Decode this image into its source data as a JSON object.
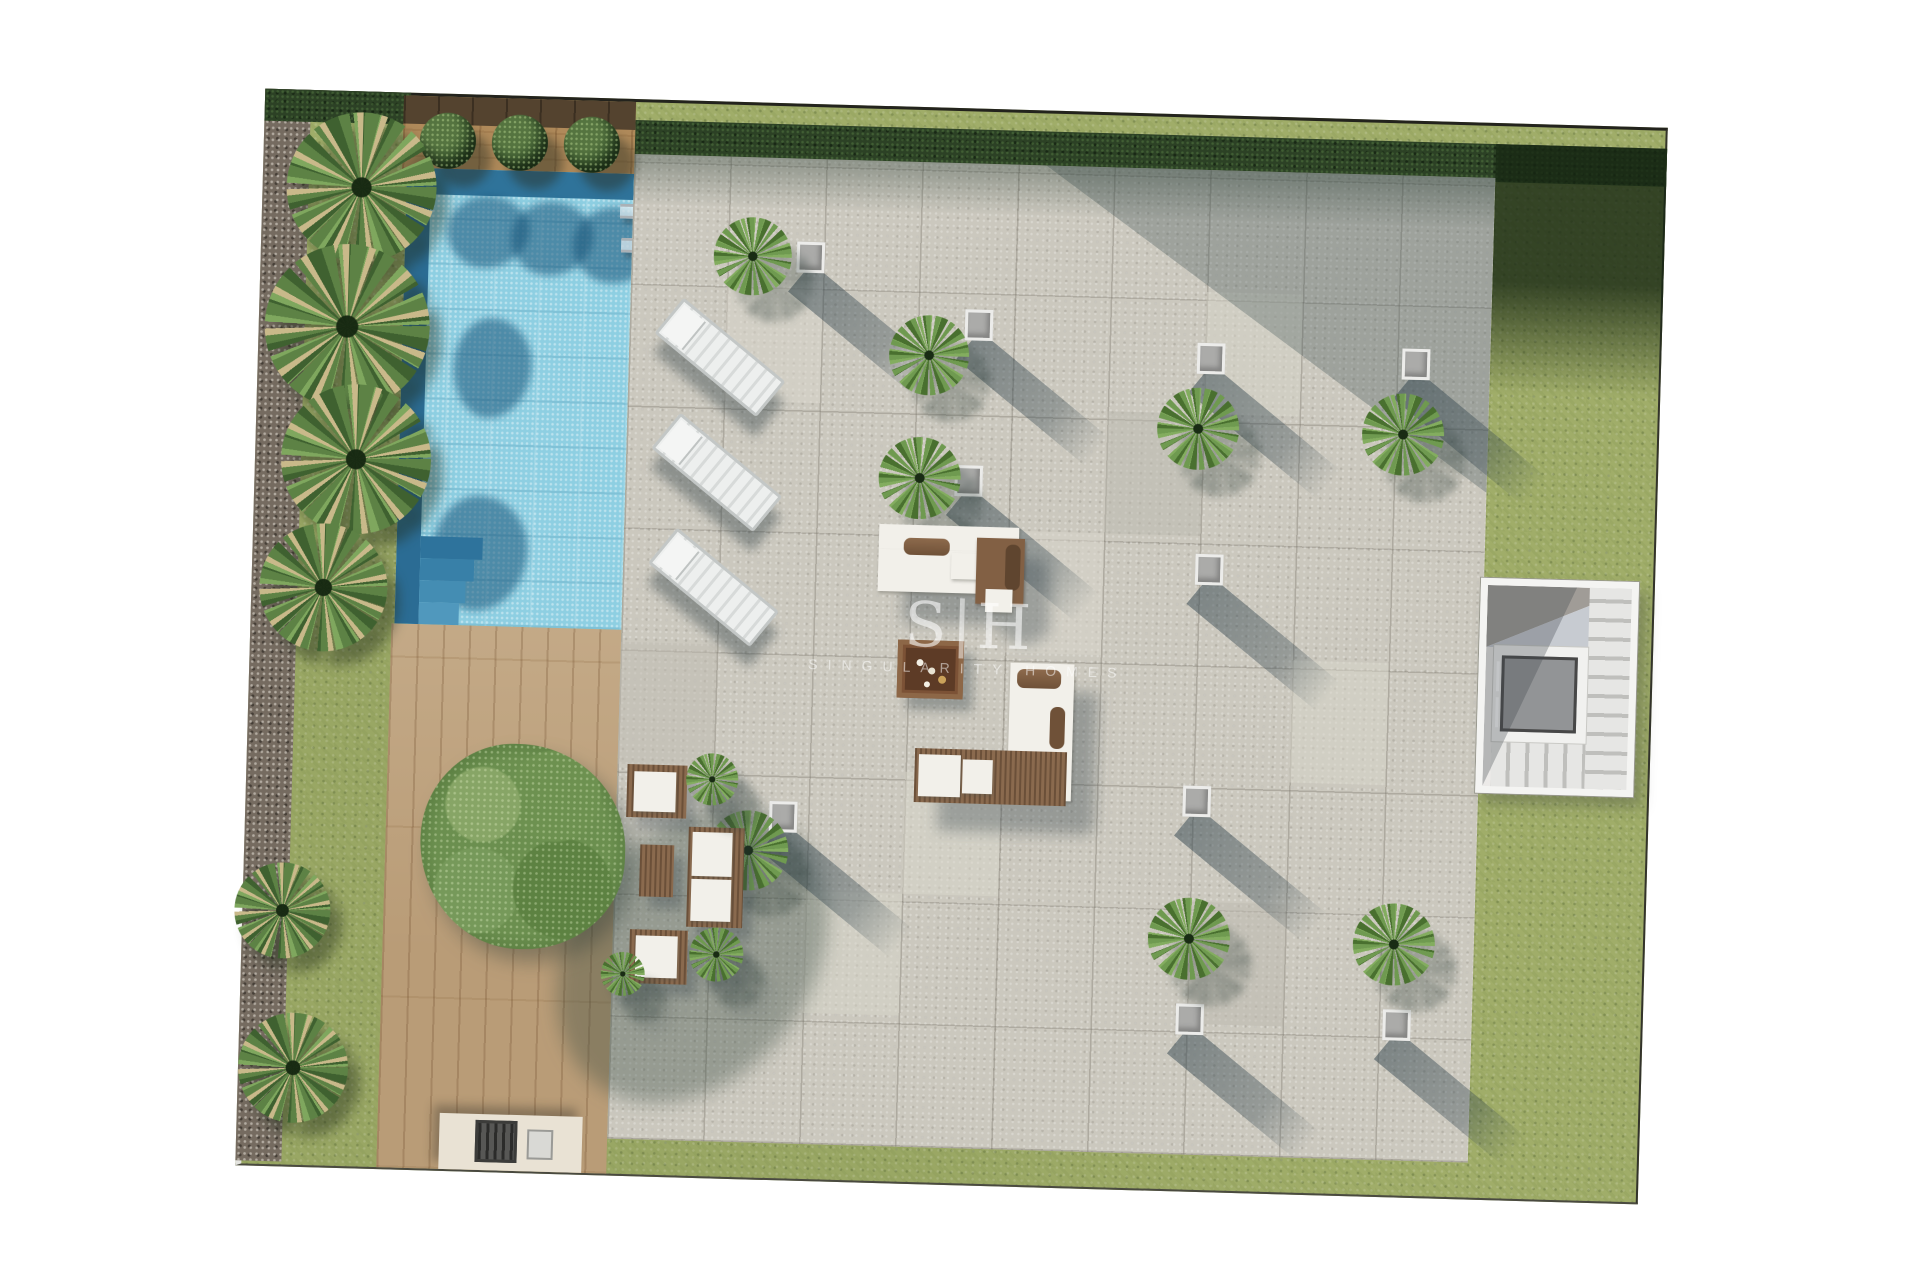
{
  "watermark": {
    "monogram_left": "S",
    "monogram_divider": "|",
    "monogram_right": "H",
    "company": "SINGULARITY HOMES"
  },
  "scene": {
    "description": "top-down architectural render of a villa garden terrace with pool",
    "regions": [
      "gravel-border",
      "lawn",
      "hedge",
      "wood-planter-strip",
      "swimming-pool",
      "wood-deck",
      "stone-tile-terrace",
      "stair-elevator-core"
    ],
    "counts": {
      "boxwood_bushes": 3,
      "sun_loungers": 3,
      "seating_groups": 3,
      "fire_pit_tables": 1,
      "square_planters": 10,
      "terrace_palms": 9,
      "border_palms": 6,
      "large_trees": 1,
      "bbq_stations": 1
    },
    "bushes": [
      {
        "x": 178,
        "y": 44
      },
      {
        "x": 250,
        "y": 44
      },
      {
        "x": 322,
        "y": 44
      }
    ],
    "left_palms": [
      {
        "x": 18,
        "y": 18,
        "s": 150
      },
      {
        "x": 0,
        "y": 150,
        "s": 165
      },
      {
        "x": 20,
        "y": 290,
        "s": 150
      },
      {
        "x": 2,
        "y": 430,
        "s": 128
      },
      {
        "x": -14,
        "y": 770,
        "s": 96
      },
      {
        "x": -6,
        "y": 920,
        "s": 110
      }
    ],
    "terrace_palms": [
      {
        "x": 447,
        "y": 112,
        "s": 78
      },
      {
        "x": 625,
        "y": 205,
        "s": 80
      },
      {
        "x": 895,
        "y": 270,
        "s": 82
      },
      {
        "x": 1100,
        "y": 270,
        "s": 82
      },
      {
        "x": 618,
        "y": 327,
        "s": 82
      },
      {
        "x": 458,
        "y": 705,
        "s": 80
      },
      {
        "x": 900,
        "y": 780,
        "s": 82
      },
      {
        "x": 1105,
        "y": 780,
        "s": 82
      }
    ],
    "planters": [
      {
        "x": 530,
        "y": 135
      },
      {
        "x": 700,
        "y": 198
      },
      {
        "x": 933,
        "y": 225
      },
      {
        "x": 1138,
        "y": 225
      },
      {
        "x": 694,
        "y": 354
      },
      {
        "x": 937,
        "y": 436
      },
      {
        "x": 931,
        "y": 668
      },
      {
        "x": 518,
        "y": 695
      },
      {
        "x": 930,
        "y": 886
      },
      {
        "x": 1137,
        "y": 886
      }
    ],
    "loungers": [
      {
        "x": 390,
        "y": 230
      },
      {
        "x": 390,
        "y": 345
      },
      {
        "x": 390,
        "y": 460
      }
    ]
  },
  "palette": {
    "page_background": "#ffffff",
    "lawn_green": "#a0ad69",
    "hedge_dark_green": "#2c4125",
    "gravel_gray": "#756b60",
    "pool_water": "#8ecfe2",
    "pool_edge_blue": "#2b6c94",
    "deck_wood": "#b99c77",
    "planter_wood": "#b08a5a",
    "tile_stone": "#cbc8be",
    "planter_gray": "#ababa9",
    "sofa_white": "#f2f0ea",
    "cushion_brown": "#826044",
    "shadow_blue_gray": "rgba(47,66,76,0.45)"
  }
}
